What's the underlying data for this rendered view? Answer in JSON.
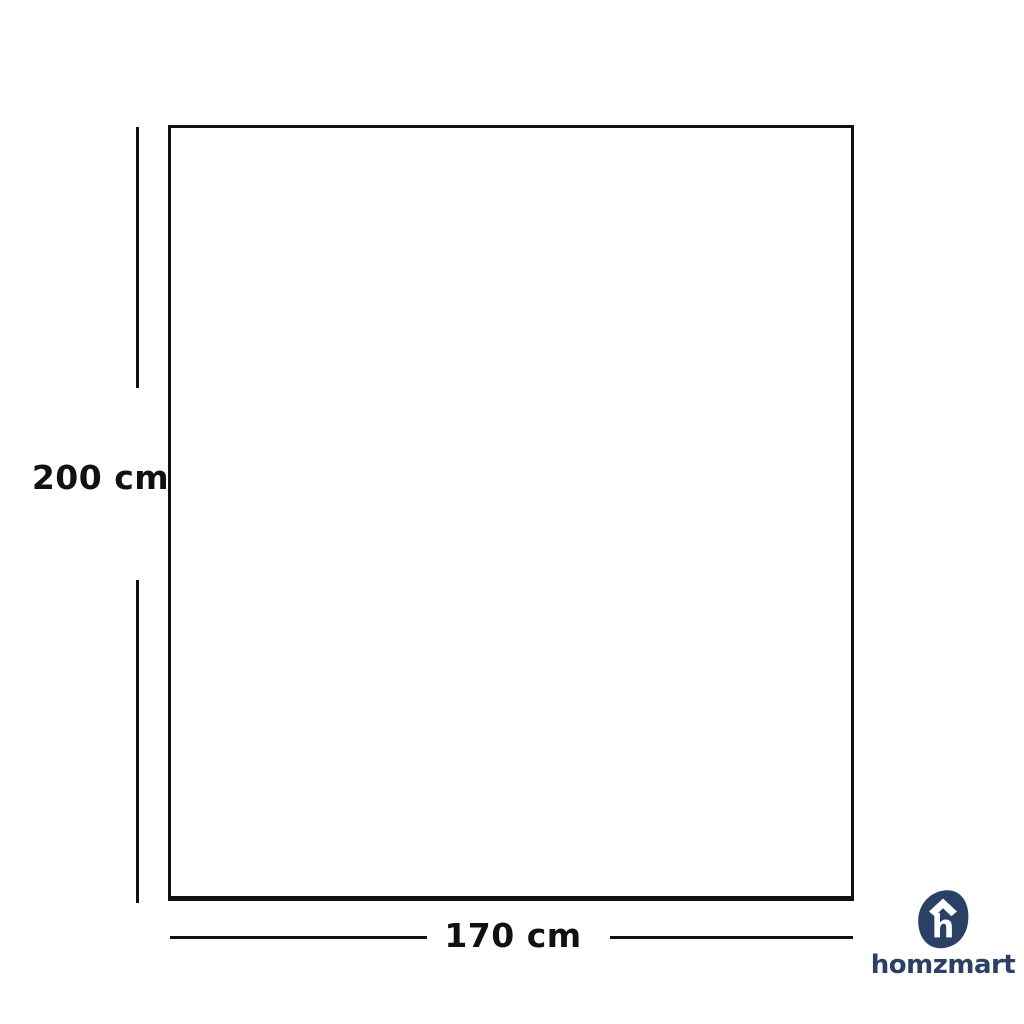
{
  "diagram": {
    "height_dimension": {
      "label": "200 cm"
    },
    "width_dimension": {
      "label": "170 cm"
    },
    "outline_color": "#111111"
  },
  "branding": {
    "wordmark": "homzmart",
    "logo_letter": "h",
    "icon": "homzmart-house-h-icon",
    "brand_color": "#2a4064"
  }
}
